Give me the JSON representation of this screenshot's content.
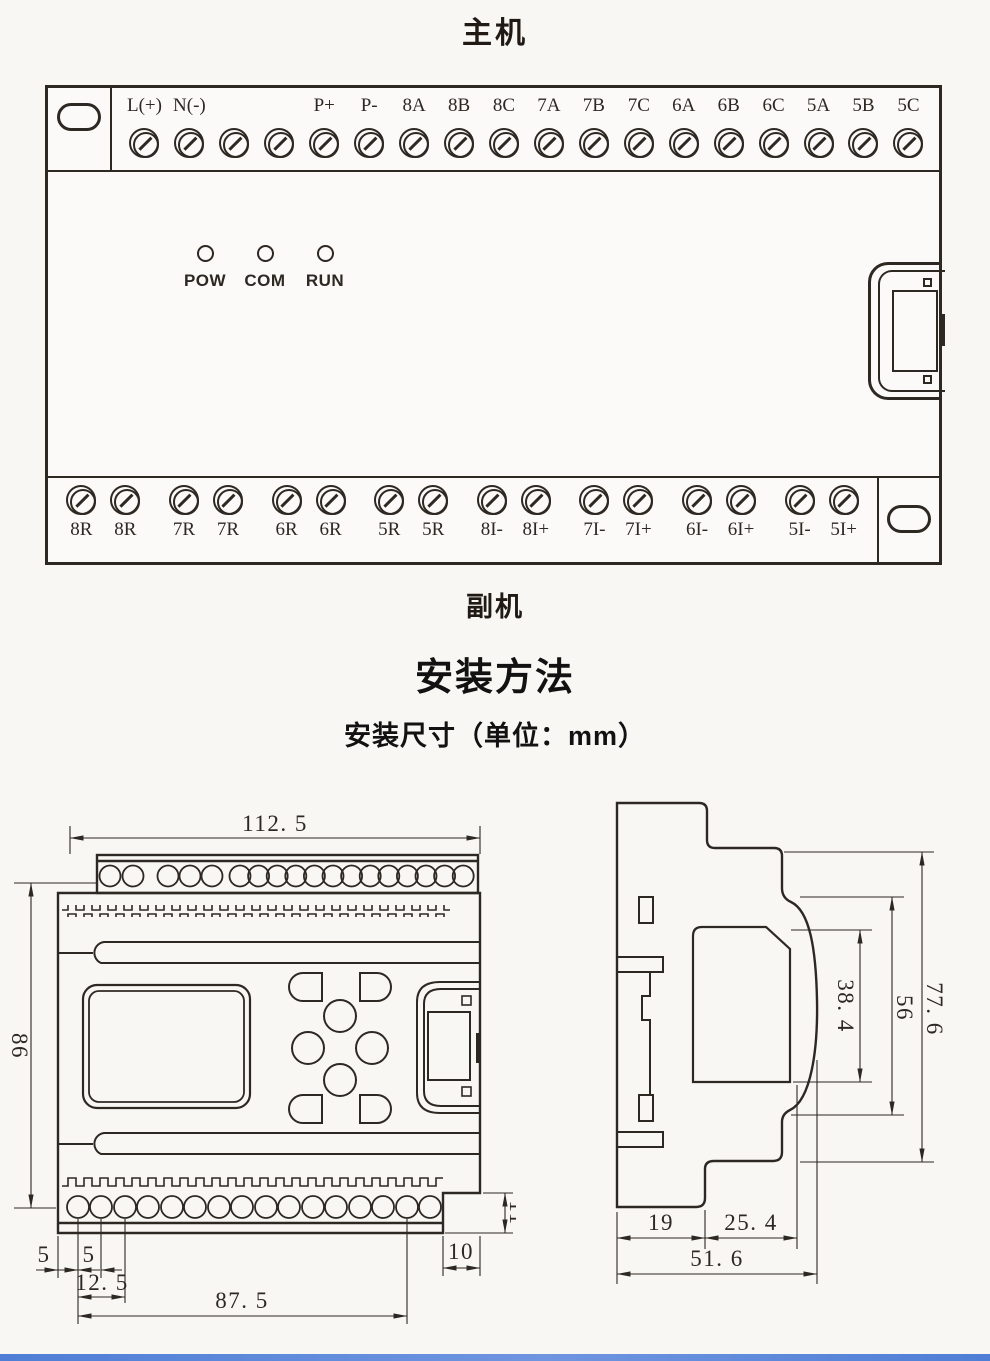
{
  "titles": {
    "top": "主机",
    "middle": "副机",
    "section": "安装方法",
    "subsection": "安装尺寸（单位：mm）"
  },
  "main_unit": {
    "top_terminals": [
      "L(+)",
      "N(-)",
      "",
      "",
      "P+",
      "P-",
      "8A",
      "8B",
      "8C",
      "7A",
      "7B",
      "7C",
      "6A",
      "6B",
      "6C",
      "5A",
      "5B",
      "5C"
    ],
    "bottom_terminals": [
      "8R",
      "8R",
      "7R",
      "7R",
      "6R",
      "6R",
      "5R",
      "5R",
      "8I-",
      "8I+",
      "7I-",
      "7I+",
      "6I-",
      "6I+",
      "5I-",
      "5I+"
    ],
    "leds": [
      "POW",
      "COM",
      "RUN"
    ]
  },
  "front_view_dims": {
    "overall_width": "112. 5",
    "overall_height": "86",
    "edge_margin": "5",
    "hole_gap": "5",
    "pair_pitch": "12. 5",
    "hole_span": "87. 5",
    "corner_step_width": "10",
    "corner_step_height": "11"
  },
  "side_view_dims": {
    "back_depth": "19",
    "front_depth": "25. 4",
    "overall_depth": "51. 6",
    "panel_height": "38. 4",
    "front_height": "56",
    "overall_height": "77. 6"
  },
  "colors": {
    "line": "#2e2823",
    "accent_bar": "#4f7ed6"
  }
}
